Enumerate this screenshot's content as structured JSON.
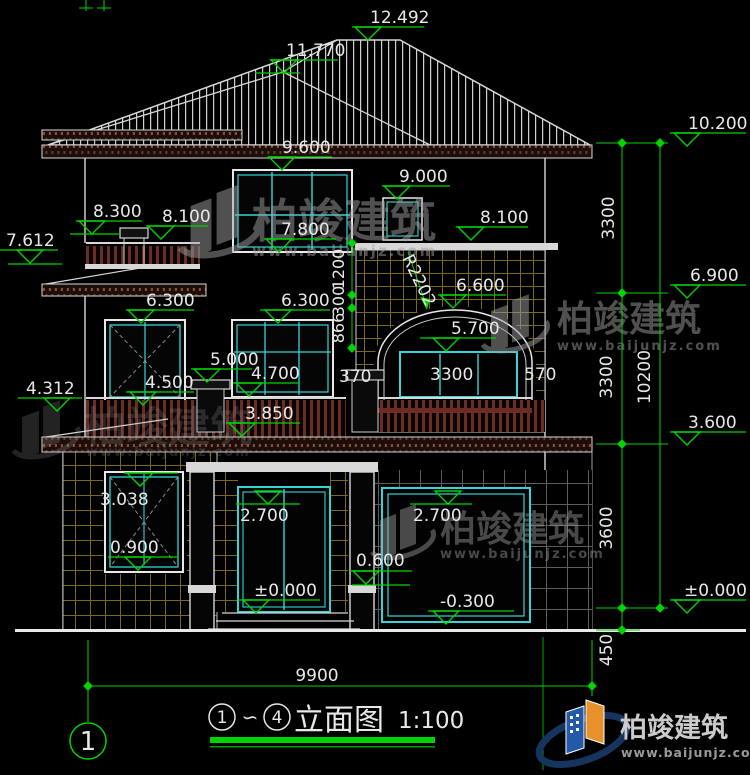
{
  "drawing": {
    "levels": {
      "ridge": "12.492",
      "hip": "11.770",
      "eave_right": "10.200",
      "win3_top": "9.600",
      "win3s_top": "9.000",
      "balc3_post": "8.300",
      "balc3_slab": "8.100",
      "win3_sill": "7.800",
      "slab3_right": "8.100",
      "skirt3": "7.612",
      "level3_right": "6.900",
      "win2l_top": "6.300",
      "win2m_top": "6.300",
      "arch_top": "6.600",
      "arch_win_top": "5.700",
      "post2_cap": "5.000",
      "win2m_sill": "4.700",
      "win2l_sill": "4.500",
      "skirt2": "4.312",
      "balc2_floor": "3.850",
      "level2_right": "3.600",
      "win1_top": "3.038",
      "door_top": "2.700",
      "garage_top": "2.700",
      "win1_sill": "0.900",
      "ledge": "0.600",
      "floor0": "±0.000",
      "garage_floor": "-0.300",
      "floor0_right": "±0.000"
    },
    "dims": {
      "right_seg1": "3300",
      "right_seg2": "3300",
      "right_seg3": "3600",
      "right_seg4": "450",
      "right_total": "10200",
      "chain_1": "1200",
      "chain_2": "300",
      "chain_3": "866",
      "arch_left": "370",
      "arch_win": "3300",
      "arch_right": "570",
      "total_width": "9900",
      "radius": "R2202"
    },
    "axis": {
      "start": "1",
      "end": "4"
    }
  },
  "title": {
    "prefix": "1",
    "tilde": "∽",
    "suffix": "4",
    "name": "立面图",
    "scale": "1:100"
  },
  "brand": {
    "name": "柏竣建筑",
    "url": "www.baijunjz.com"
  },
  "colors": {
    "dim_green": "#00d400",
    "glass_cyan": "#33d6d6",
    "tile_olive": "#7c671f",
    "rail_red": "#6e2b21",
    "logo_blue": "#2458a8",
    "logo_orange": "#e8912a"
  }
}
